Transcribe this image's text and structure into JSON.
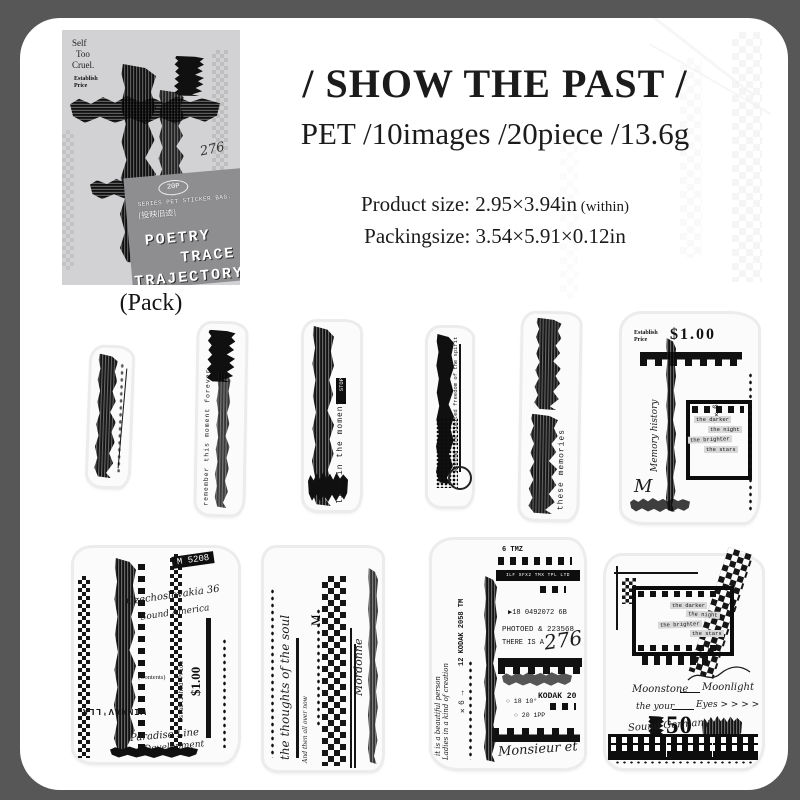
{
  "header": {
    "title": "/ SHOW THE PAST /",
    "subtitle": "PET /10images /20piece /13.6g",
    "product_size": "Product size: 2.95×3.94in",
    "product_size_suffix": " (within)",
    "packing_size": "Packingsize: 3.54×5.91×0.12in"
  },
  "package": {
    "corner_line1": "Self",
    "corner_line2": "Too",
    "corner_line3": "Cruel.",
    "establish_line1": "Establish",
    "establish_line2": "Price",
    "number_script": "276",
    "badge": "20P",
    "series": "SERIES PET STICKER BAG.",
    "chinese": "[投映旧迹]",
    "title_line1": "POETRY",
    "title_line2": "TRACE",
    "title_line3": "TRAJECTORY",
    "caption": "(Pack)"
  },
  "stickers": {
    "r1s2": {
      "text": "remember this moment forever"
    },
    "r1s3": {
      "text": "live in the moment",
      "tag": "STOP"
    },
    "r1s4": {
      "text": "whether are limited freedom of the spirit"
    },
    "r1s5": {
      "text": "these memories"
    },
    "r1s6": {
      "establish": "Establish",
      "price_word": "Price",
      "price": "$1.00",
      "x6": "×6",
      "arrow": "↑",
      "script": "Memory history",
      "big_m": "M",
      "labels": [
        "the darker",
        "the night",
        "the brighter",
        "the stars"
      ]
    },
    "r2s1": {
      "tag": "M 5208",
      "script1": "Czechoslovakia 36",
      "script2": "Sound America",
      "price": "$1.00",
      "price_label": "Established Price",
      "contents": "(Contents)",
      "inverted": "WIMMAV'LLA",
      "script3": "Paradise Line",
      "script4": "Development"
    },
    "r2s2": {
      "script_main": "the thoughts of the soul",
      "script_small": "And then all over now",
      "letter": "M",
      "script_right": "Mordonne"
    },
    "r2s3": {
      "top": "6 TMZ",
      "bar": "ILF SFX2 TMX TPL LTD",
      "code": "▶18  0492072  6B",
      "photoed": "PHOTOED & 223568",
      "there": "THERE IS A",
      "number": "276",
      "kodak": "KODAK 20",
      "side": "12 KODAK 2058 TM",
      "x6": "×6 →",
      "circle1": "○ 18 10°",
      "circle2": "○ 20 1PP",
      "script_left1": "it is a beautiful person",
      "script_left2": "Ladies in a kind of creation",
      "script_bottom": "Monsieur et"
    },
    "r2s4": {
      "labels": [
        "the darker",
        "the night",
        "the brighter",
        "the stars"
      ],
      "line1a": "Moonstone",
      "line1b": "Moonlight",
      "line2a": "the your",
      "line2b": "Eyes > > > >",
      "stamp": "50",
      "script": "Sound Germany"
    }
  }
}
